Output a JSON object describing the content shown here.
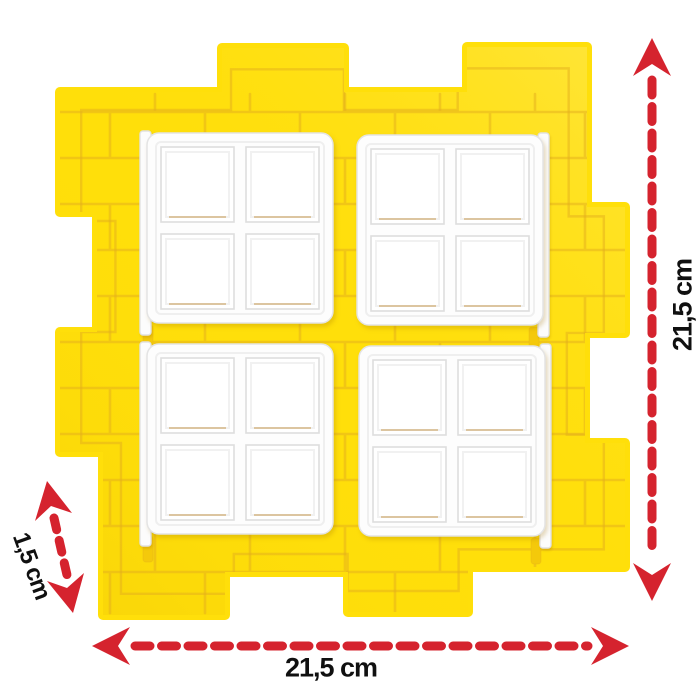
{
  "image": {
    "subject": "yellow toy brick wall panel with four white four-pane windows",
    "annotation_type": "product dimensions"
  },
  "dimensions": {
    "width_label": "21,5 cm",
    "height_label": "21,5 cm",
    "depth_label": "1,5 cm"
  },
  "colors": {
    "arrow_red": "#D5232E",
    "panel_yellow": "#FFDF0A",
    "panel_groove": "#E3AE1E",
    "window_white": "#FFFFFF",
    "label_text": "#101010",
    "background": "#FFFFFF"
  }
}
